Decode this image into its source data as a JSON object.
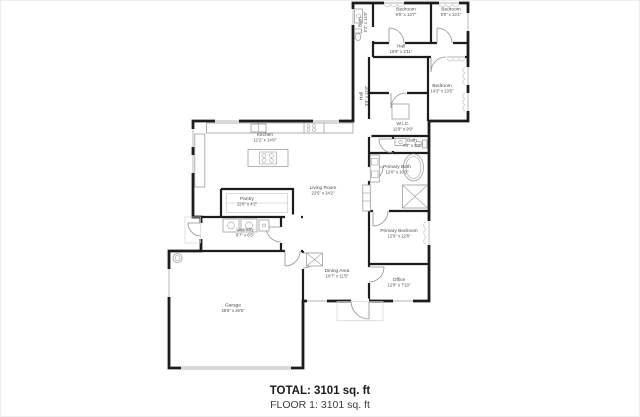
{
  "summary": {
    "total": "TOTAL: 3101 sq. ft",
    "floor": "FLOOR 1: 3101 sq. ft"
  },
  "rooms": {
    "bath_top": {
      "name": "Bath",
      "dims": "5'2\" x 14'9\""
    },
    "bedroom1": {
      "name": "Bedroom",
      "dims": "9'0\" x 13'7\""
    },
    "bedroom2": {
      "name": "Bedroom",
      "dims": "9'0\" x 13'1\""
    },
    "hall_top": {
      "name": "Hall",
      "dims": "19'6\" x 2'11\""
    },
    "hall_vert": {
      "name": "Hall",
      "dims": "3'5\" x 11'8\""
    },
    "bedroom_right": {
      "name": "Bedroom",
      "dims": "14'3\" x 13'5\""
    },
    "wic": {
      "name": "W.I.C.",
      "dims": "11'9\" x 9'9\""
    },
    "bath_small": {
      "name": "Bath",
      "dims": "7'2\" x 3'9\""
    },
    "primary_bath": {
      "name": "Primary Bath",
      "dims": "12'0\" x 10'3\""
    },
    "living": {
      "name": "Living Room",
      "dims": "22'5\" x 24'2\""
    },
    "kitchen": {
      "name": "Kitchen",
      "dims": "11'2\" x 14'0\""
    },
    "pantry": {
      "name": "Pantry",
      "dims": "11'0\" x 4'2\""
    },
    "laundry": {
      "name": "Laundry",
      "dims": "9'7\" x 6'5\""
    },
    "primary_bedroom": {
      "name": "Primary Bedroom",
      "dims": "12'9\" x 12'8\""
    },
    "dining": {
      "name": "Dining Area",
      "dims": "10'7\" x 11'5\""
    },
    "office": {
      "name": "Office",
      "dims": "12'9\" x 7'10\""
    },
    "garage": {
      "name": "Garage",
      "dims": "28'8\" x 26'5\""
    }
  },
  "colors": {
    "wall": "#1c1c1c",
    "fixture": "#9e9e9e",
    "door": "#8f8f8f",
    "label": "#4c4c4c",
    "window": "#9e9e9e",
    "decor": "#c9c9c9",
    "page_bg": "#ffffff",
    "border": "#ededed",
    "summary_total": "#1a1a1a",
    "summary_floor": "#3d3d3d"
  }
}
